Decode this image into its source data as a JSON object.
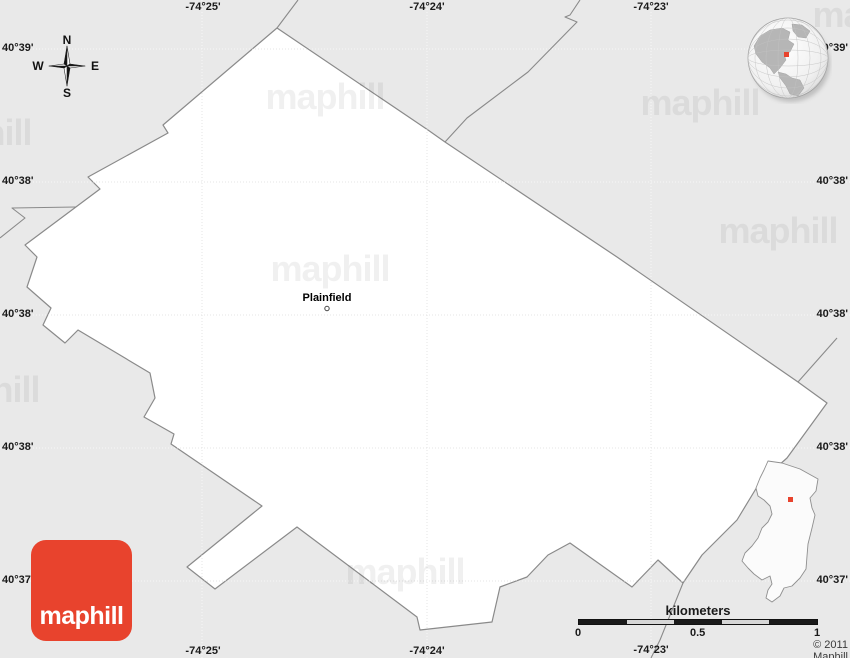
{
  "map": {
    "place_label": "Plainfield",
    "copyright": "© 2011 Maphill",
    "compass": {
      "n": "N",
      "e": "E",
      "s": "S",
      "w": "W"
    },
    "scale": {
      "title": "kilometers",
      "ticks": [
        {
          "text": "0"
        },
        {
          "text": "0.5"
        },
        {
          "text": "1"
        }
      ]
    },
    "grid": {
      "top_labels": [
        {
          "text": "-74°25'"
        },
        {
          "text": "-74°24'"
        },
        {
          "text": "-74°23'"
        }
      ],
      "bottom_labels": [
        {
          "text": "-74°25'"
        },
        {
          "text": "-74°24'"
        },
        {
          "text": "-74°23'"
        }
      ],
      "left_labels": [
        {
          "text": "40°39'"
        },
        {
          "text": "40°38'"
        },
        {
          "text": "40°38'"
        },
        {
          "text": "40°38'"
        },
        {
          "text": "40°37'"
        }
      ],
      "right_labels": [
        {
          "text": "40°39'"
        },
        {
          "text": "40°38'"
        },
        {
          "text": "40°38'"
        },
        {
          "text": "40°38'"
        },
        {
          "text": "40°37'"
        }
      ]
    },
    "branding": {
      "logo_text": "maphill",
      "watermark_text": "maphill"
    },
    "colors": {
      "background": "#e9e9e9",
      "land": "#ffffff",
      "boundary": "#8a8a8a",
      "accent_red": "#e8432d",
      "label_color": "#1a1a1a"
    }
  }
}
